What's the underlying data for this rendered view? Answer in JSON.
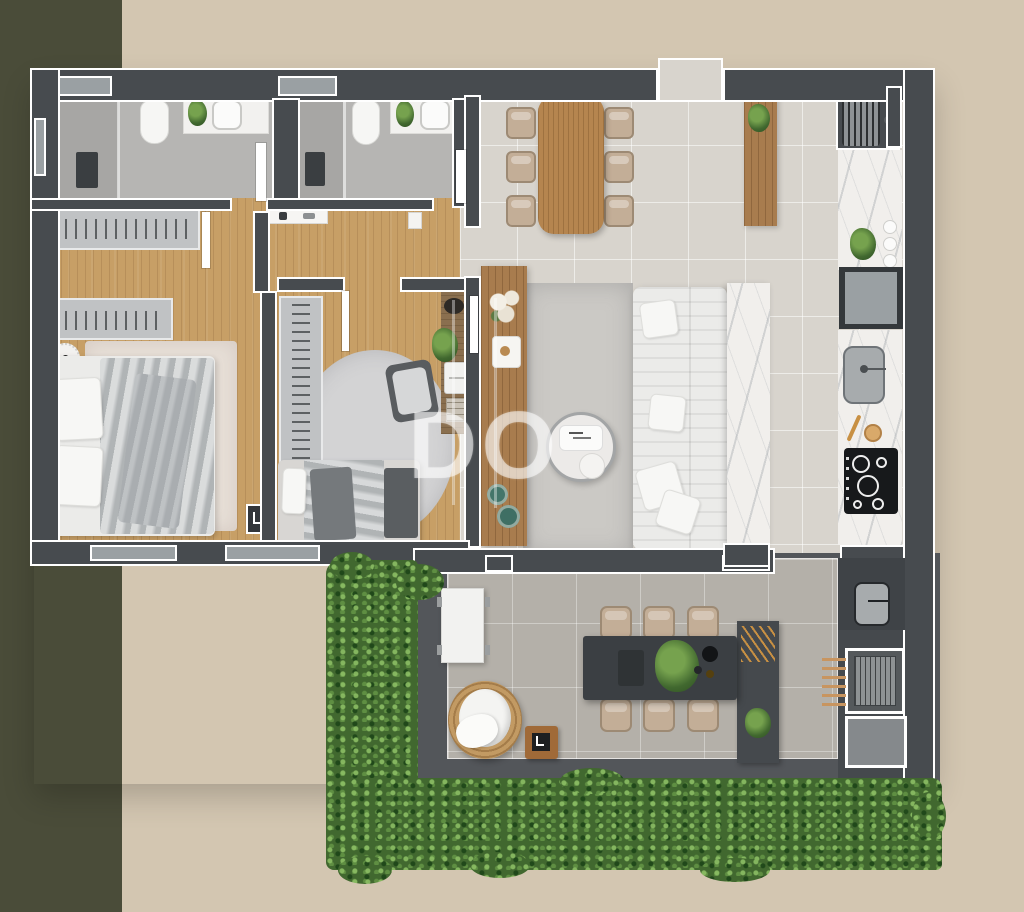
{
  "watermark": {
    "text": "DO"
  },
  "palette": {
    "beige": "#d3c6b1",
    "olive": "#4a4c39",
    "wall": "#474b4f",
    "outline": "#ffffff",
    "wood-floor": "#c79f66",
    "wood-dark": "#a87c4e",
    "wood-table": "#b5854f",
    "tile": "#d8d4cd",
    "bath-tile": "#b6b5b3",
    "shower": "#a7a6a4",
    "terrace-tile": "#b4b0a9",
    "terrace-dark": "#53565a",
    "platform": "#45494d",
    "green": "#41682f",
    "green-light": "#76a24e",
    "green-deep": "#2e4f22",
    "sofa": "#ebebe9",
    "marble": "#f1efec",
    "rug": "#cbc9c5",
    "rug-cream": "#e7dfd7",
    "rug-round": "#d3d3d4",
    "duvet": "#c6c9ca",
    "throw": "#a9adb0",
    "wardrobe": "#c0c2c4",
    "dark-table": "#3b3f43",
    "chair-tan": "#c3ae97",
    "chair-frame": "#9d8a74",
    "cooktop": "#17191b",
    "appliance": "#9aa0a3",
    "sink": "#a7abad",
    "gold": "#c89043",
    "teal": "#44756a",
    "white-f": "#f2f2f0",
    "glass": "#9aa0a3"
  },
  "scene": {
    "type": "apartment-floor-plan-3d-top-view",
    "rooms": [
      {
        "name": "bathroom-1",
        "items": [
          "shower",
          "toilet",
          "vanity-sink",
          "plant"
        ]
      },
      {
        "name": "bathroom-2",
        "items": [
          "shower",
          "toilet",
          "vanity-sink",
          "plant"
        ]
      },
      {
        "name": "master-bedroom",
        "items": [
          "wardrobe-top",
          "wardrobe-left",
          "double-bed",
          "cream-rug",
          "round-nightstand-1",
          "round-nightstand-2",
          "leaning-frame"
        ]
      },
      {
        "name": "bedroom-2",
        "items": [
          "wardrobe",
          "round-rug",
          "armchair",
          "desk-with-laptop-plant-books",
          "single-bed",
          "foot-bench"
        ]
      },
      {
        "name": "corridor",
        "items": [
          "wall-console"
        ]
      },
      {
        "name": "dining-area",
        "items": [
          "wood-dining-table",
          "six-chairs",
          "wood-console-with-plant"
        ]
      },
      {
        "name": "living-room",
        "items": [
          "white-modular-sofa",
          "round-coffee-table",
          "gray-rug",
          "wood-sideboard-with-flowers",
          "marble-tv-panel"
        ]
      },
      {
        "name": "kitchen",
        "items": [
          "laundry-unit",
          "marble-counter",
          "jars",
          "plant",
          "fridge",
          "sink",
          "cooktop",
          "gold-utensils"
        ]
      },
      {
        "name": "terrace",
        "items": [
          "white-side-table",
          "rattan-lounge-chair",
          "wood-stool",
          "dark-outdoor-dining-table",
          "six-outdoor-chairs",
          "serving-platform-with-skewers",
          "outdoor-sink",
          "barbecue-grill",
          "outdoor-cabinet",
          "vertical-garden",
          "hedge"
        ]
      }
    ]
  }
}
